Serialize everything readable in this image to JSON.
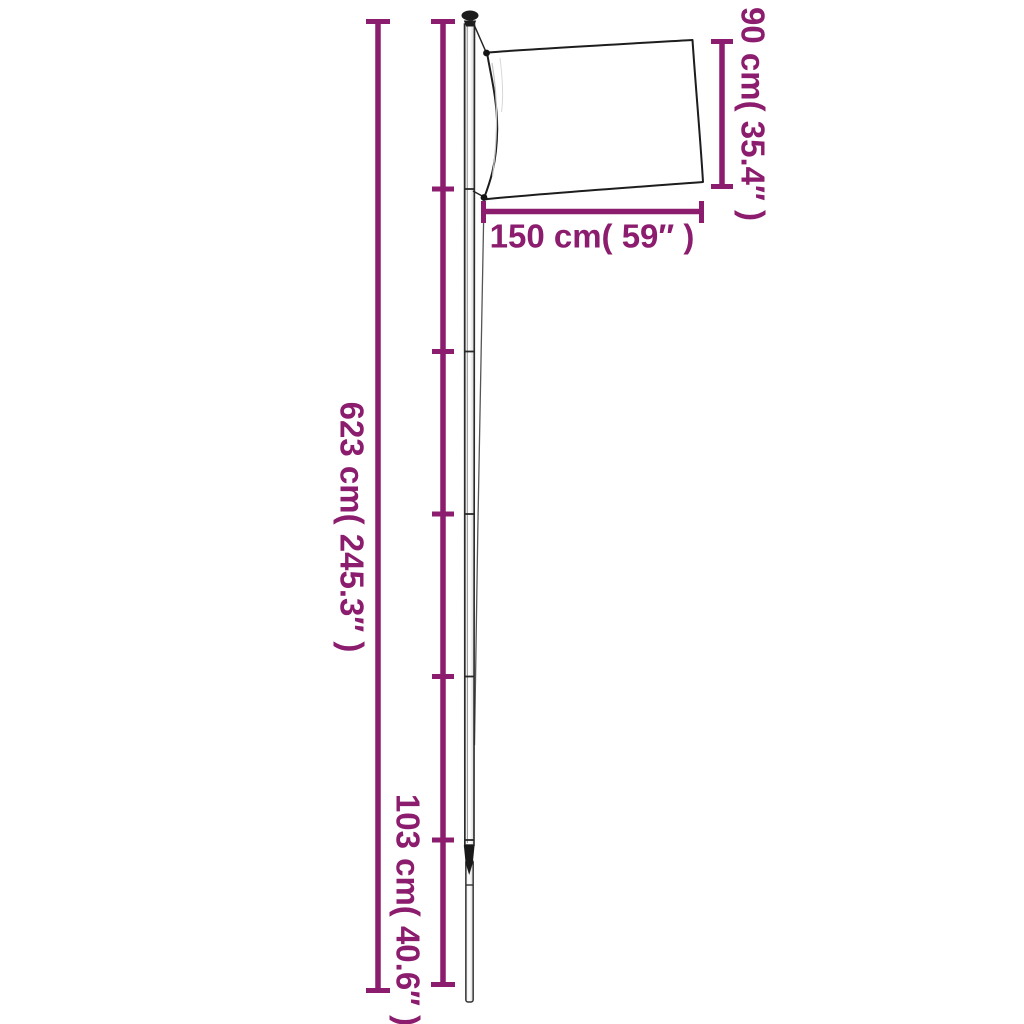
{
  "diagram": {
    "title": "flagpole-with-flag-dimension-diagram",
    "colors": {
      "accent": "#8B1C6E",
      "outline": "#1d1d1d",
      "background": "#ffffff"
    },
    "measurements": {
      "total_height": {
        "cm": "623",
        "inches": "245.3",
        "label": "623 cm( 245.3″ )"
      },
      "flag_width": {
        "cm": "150",
        "inches": "59",
        "label": "150 cm( 59″ )"
      },
      "flag_height": {
        "cm": "90",
        "inches": "35.4",
        "label": "90 cm( 35.4″ )"
      },
      "bottom_section": {
        "cm": "103",
        "inches": "40.6",
        "label": "103 cm( 40.6″ )"
      }
    }
  }
}
